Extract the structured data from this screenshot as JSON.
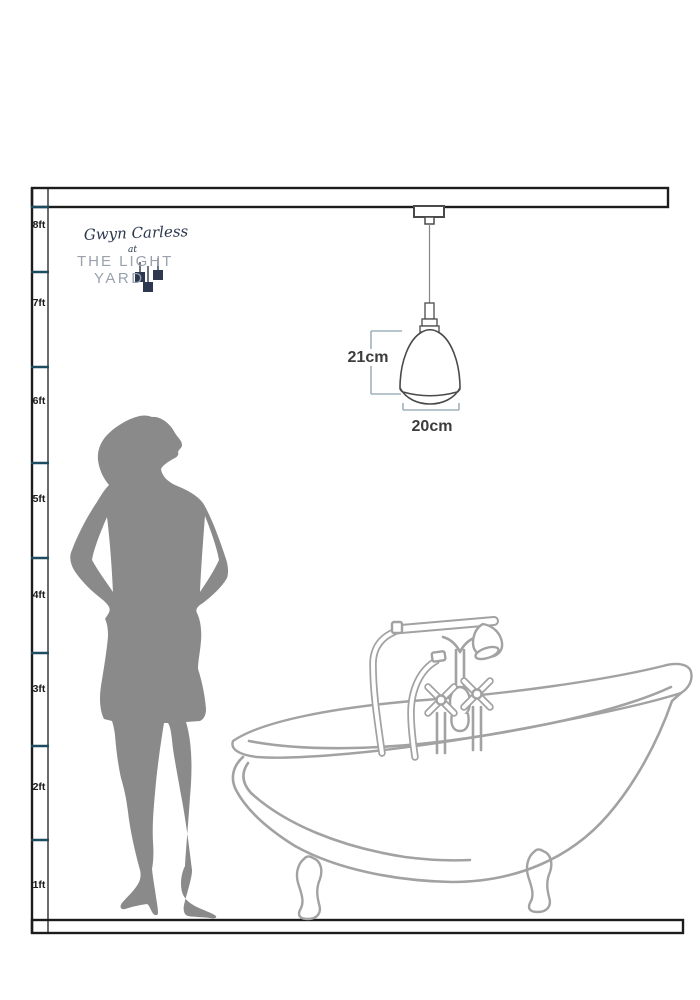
{
  "brand": {
    "signature": "Gwyn Carless",
    "at": "at",
    "name_line1": "THE LIGHT",
    "name_line2": "YARD"
  },
  "ruler": {
    "labels": [
      "8ft",
      "7ft",
      "6ft",
      "5ft",
      "4ft",
      "3ft",
      "2ft",
      "1ft"
    ]
  },
  "product_dimensions": {
    "height_label": "21cm",
    "width_label": "20cm"
  },
  "illustrations": [
    "pendant-light",
    "woman-silhouette",
    "clawfoot-bathtub",
    "ceiling-line",
    "floor-line",
    "height-ruler"
  ],
  "colors": {
    "frame": "#1c1c1c",
    "tick": "#1e4d61",
    "ruler_text": "#1a1a1a",
    "dimension_line": "#9fb3bb",
    "dimension_text": "#3c3c3c",
    "drawing_dark": "#4a4a4a",
    "drawing_light": "#a2a2a2",
    "silhouette": "#8a8a8a",
    "brand_navy": "#2b3850",
    "brand_gray": "#99a1ad"
  }
}
